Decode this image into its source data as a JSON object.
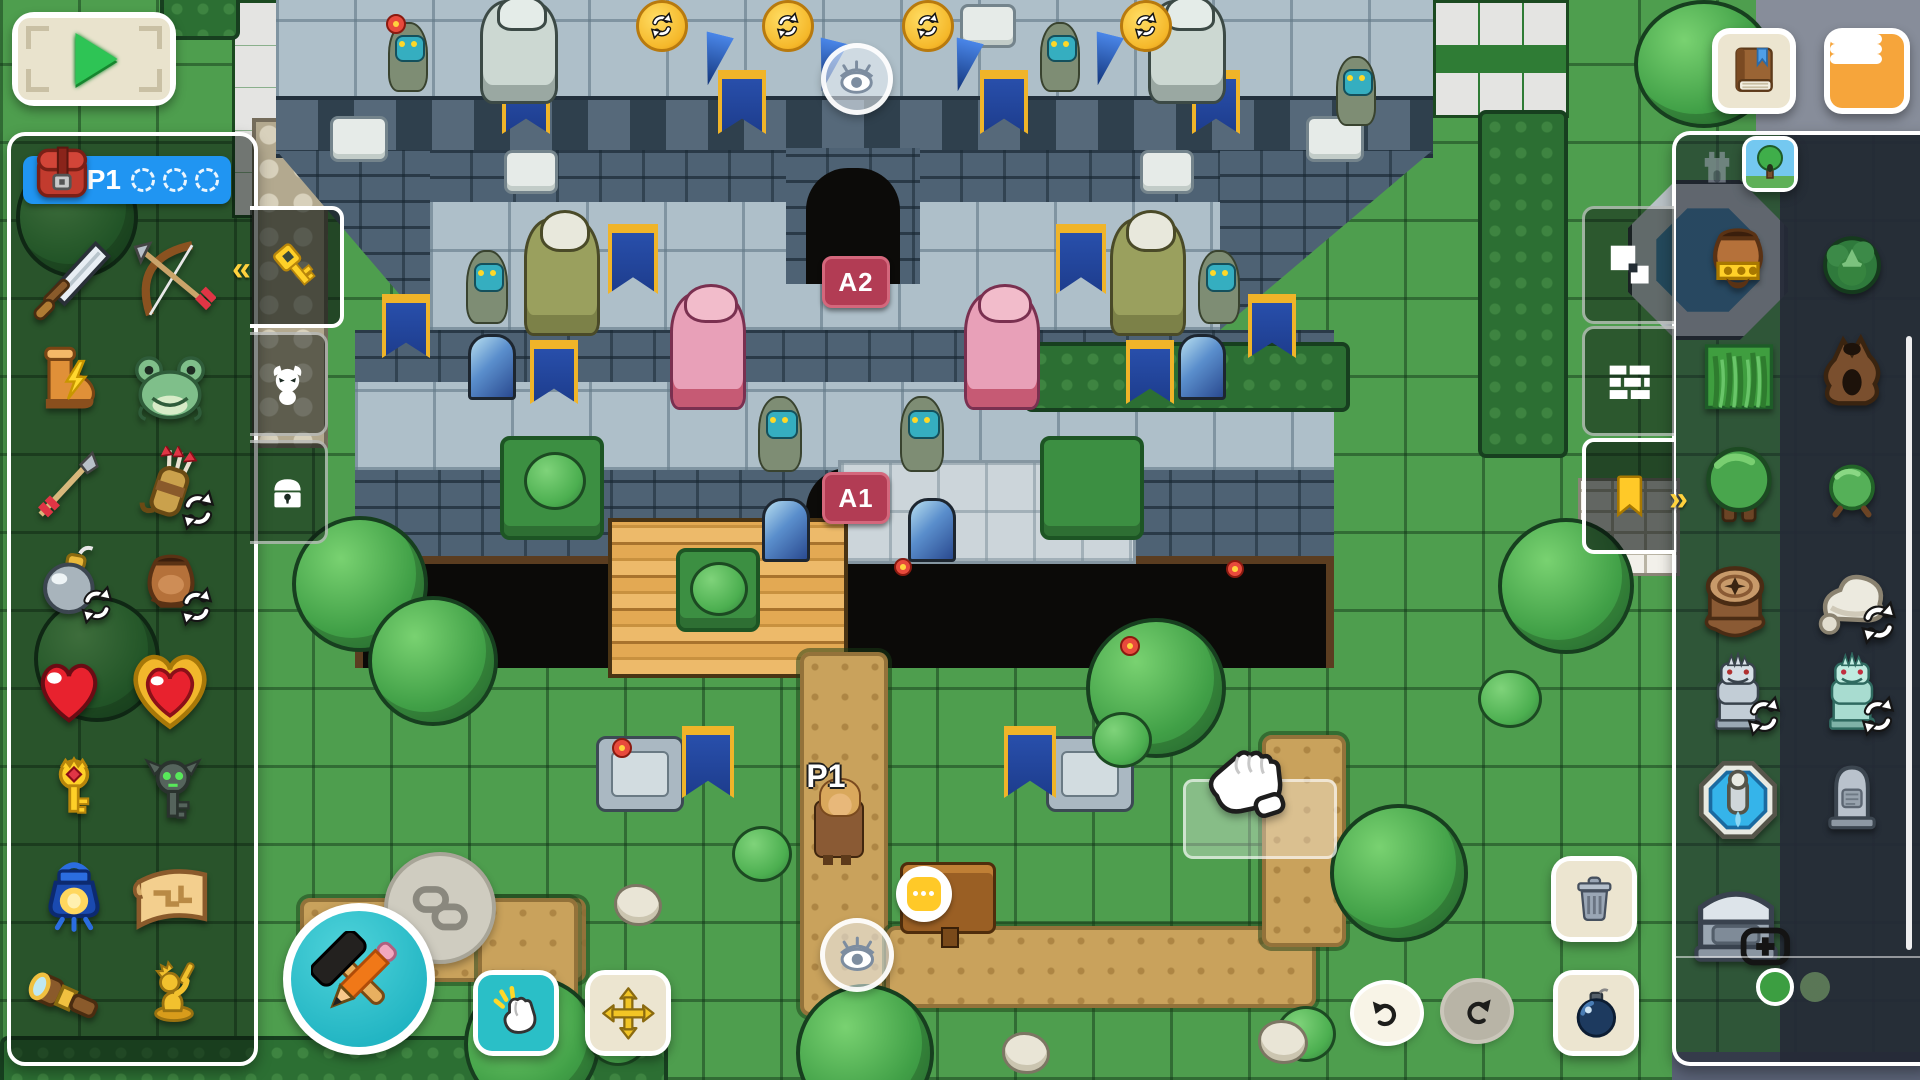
{
  "hud": {
    "play_button": {
      "icon": "play-icon"
    },
    "book_button": {
      "icon": "book-icon"
    },
    "menu_button": {
      "icon": "hamburger-icon"
    },
    "player_bar": {
      "label": "P1",
      "empty_slots": 3
    }
  },
  "left_panel": {
    "tabs": [
      {
        "id": "items",
        "icon": "key-icon",
        "active": true,
        "chevron": "«"
      },
      {
        "id": "enemies",
        "icon": "imp-icon",
        "active": false
      },
      {
        "id": "treasure",
        "icon": "chest-icon",
        "active": false
      }
    ],
    "items": [
      {
        "id": "sword",
        "x": 26,
        "y": 238,
        "s": 88
      },
      {
        "id": "bow",
        "x": 128,
        "y": 236,
        "s": 88
      },
      {
        "id": "boots",
        "x": 30,
        "y": 342,
        "s": 76
      },
      {
        "id": "frog",
        "x": 128,
        "y": 344,
        "s": 84
      },
      {
        "id": "arrow",
        "x": 24,
        "y": 448,
        "s": 80
      },
      {
        "id": "quiver",
        "x": 132,
        "y": 446,
        "s": 80,
        "cycle": true
      },
      {
        "id": "bomb",
        "x": 34,
        "y": 544,
        "s": 76,
        "cycle": true
      },
      {
        "id": "pot",
        "x": 132,
        "y": 544,
        "s": 78,
        "cycle": true
      },
      {
        "id": "heart",
        "x": 30,
        "y": 652,
        "s": 78
      },
      {
        "id": "heart-container",
        "x": 126,
        "y": 646,
        "s": 88
      },
      {
        "id": "boss-key",
        "x": 40,
        "y": 756,
        "s": 68
      },
      {
        "id": "demon-key",
        "x": 136,
        "y": 756,
        "s": 74
      },
      {
        "id": "lantern",
        "x": 34,
        "y": 856,
        "s": 80
      },
      {
        "id": "map-scroll",
        "x": 126,
        "y": 860,
        "s": 88
      },
      {
        "id": "telescope",
        "x": 26,
        "y": 956,
        "s": 84
      },
      {
        "id": "hero-statue",
        "x": 140,
        "y": 954,
        "s": 68
      }
    ]
  },
  "right_panel": {
    "category_tabs": [
      {
        "id": "dungeon",
        "icon": "tower-icon",
        "active": false
      },
      {
        "id": "overworld",
        "icon": "tree-thumbnail-icon",
        "active": true
      }
    ],
    "side_tabs": [
      {
        "id": "ground",
        "icon": "squares-icon",
        "active": false
      },
      {
        "id": "walls",
        "icon": "bricks-icon",
        "active": false
      },
      {
        "id": "decor",
        "icon": "bookmark-icon",
        "active": true,
        "chevron": "»"
      }
    ],
    "tiles": [
      {
        "id": "money-pot",
        "x": 1698,
        "y": 220,
        "s": 80
      },
      {
        "id": "dark-bush",
        "x": 1814,
        "y": 224,
        "s": 76
      },
      {
        "id": "grass-tile",
        "x": 1698,
        "y": 334,
        "s": 82
      },
      {
        "id": "dead-tree",
        "x": 1810,
        "y": 328,
        "s": 84
      },
      {
        "id": "tree",
        "x": 1696,
        "y": 442,
        "s": 86
      },
      {
        "id": "bush",
        "x": 1816,
        "y": 450,
        "s": 72
      },
      {
        "id": "stump",
        "x": 1692,
        "y": 554,
        "s": 86
      },
      {
        "id": "rock",
        "x": 1808,
        "y": 554,
        "s": 86,
        "cycle": true
      },
      {
        "id": "gargoyle-gray",
        "x": 1698,
        "y": 652,
        "s": 80,
        "cycle": true
      },
      {
        "id": "gargoyle-teal",
        "x": 1812,
        "y": 652,
        "s": 80,
        "cycle": true
      },
      {
        "id": "fountain",
        "x": 1694,
        "y": 756,
        "s": 88
      },
      {
        "id": "gravestone",
        "x": 1814,
        "y": 758,
        "s": 76
      },
      {
        "id": "sarcophagus",
        "x": 1686,
        "y": 868,
        "s": 100,
        "plus": true
      }
    ],
    "pagination": {
      "pages": 2,
      "active_page": 1
    }
  },
  "toolbar_bottom": {
    "edit_button": {
      "icon": "hammer-pencil-icon"
    },
    "link_button": {
      "icon": "chain-icon"
    },
    "tap_button": {
      "icon": "tap-hand-icon"
    },
    "move_button": {
      "icon": "move-arrows-icon"
    },
    "undo_button": {
      "icon": "undo-icon",
      "enabled": true
    },
    "redo_button": {
      "icon": "redo-icon",
      "enabled": false
    },
    "trash_button": {
      "icon": "trash-icon"
    },
    "bomb_button": {
      "icon": "bomb-icon"
    }
  },
  "map": {
    "markers": {
      "door_upper": "A2",
      "door_lower": "A1",
      "player_spawn": "P1"
    },
    "objects": [
      {
        "t": "platform",
        "x": 500,
        "y": 436,
        "w": 96,
        "h": 96
      },
      {
        "t": "platform",
        "x": 676,
        "y": 548,
        "w": 76,
        "h": 76
      },
      {
        "t": "platform",
        "x": 1040,
        "y": 436,
        "w": 96,
        "h": 96
      },
      {
        "t": "pedestal",
        "x": 596,
        "y": 736,
        "w": 82,
        "h": 70
      },
      {
        "t": "pedestal",
        "x": 1046,
        "y": 736,
        "w": 82,
        "h": 70
      },
      {
        "t": "plaque",
        "x": 330,
        "y": 116,
        "w": 52,
        "h": 40
      },
      {
        "t": "plaque",
        "x": 1306,
        "y": 116,
        "w": 52,
        "h": 40
      },
      {
        "t": "plaque",
        "x": 504,
        "y": 150,
        "w": 48,
        "h": 38
      },
      {
        "t": "plaque",
        "x": 1140,
        "y": 150,
        "w": 48,
        "h": 38
      },
      {
        "t": "plaque",
        "x": 960,
        "y": 4,
        "w": 50,
        "h": 38
      },
      {
        "t": "window",
        "x": 468,
        "y": 334,
        "w": 42,
        "h": 60
      },
      {
        "t": "window",
        "x": 1178,
        "y": 334,
        "w": 42,
        "h": 60
      },
      {
        "t": "window",
        "x": 762,
        "y": 498,
        "w": 42,
        "h": 58
      },
      {
        "t": "window",
        "x": 908,
        "y": 498,
        "w": 42,
        "h": 58
      },
      {
        "t": "banner",
        "x": 502,
        "y": 70,
        "w": 40,
        "h": 64
      },
      {
        "t": "banner",
        "x": 718,
        "y": 70,
        "w": 40,
        "h": 64
      },
      {
        "t": "banner",
        "x": 980,
        "y": 70,
        "w": 40,
        "h": 64
      },
      {
        "t": "banner",
        "x": 1192,
        "y": 70,
        "w": 40,
        "h": 64
      },
      {
        "t": "banner",
        "x": 608,
        "y": 224,
        "w": 42,
        "h": 70
      },
      {
        "t": "banner",
        "x": 1056,
        "y": 224,
        "w": 42,
        "h": 70
      },
      {
        "t": "banner",
        "x": 382,
        "y": 294,
        "w": 40,
        "h": 64
      },
      {
        "t": "banner",
        "x": 1248,
        "y": 294,
        "w": 40,
        "h": 64
      },
      {
        "t": "banner",
        "x": 530,
        "y": 340,
        "w": 40,
        "h": 64
      },
      {
        "t": "banner",
        "x": 1126,
        "y": 340,
        "w": 40,
        "h": 64
      },
      {
        "t": "banner",
        "x": 682,
        "y": 726,
        "w": 44,
        "h": 72
      },
      {
        "t": "banner",
        "x": 1004,
        "y": 726,
        "w": 44,
        "h": 72
      },
      {
        "t": "white-gargoyle",
        "x": 480,
        "y": 0,
        "w": 72,
        "h": 98
      },
      {
        "t": "white-gargoyle",
        "x": 1148,
        "y": 0,
        "w": 72,
        "h": 98
      },
      {
        "t": "green-griffin",
        "x": 524,
        "y": 218,
        "w": 70,
        "h": 112
      },
      {
        "t": "green-griffin",
        "x": 1110,
        "y": 218,
        "w": 70,
        "h": 112
      },
      {
        "t": "pink-dragon",
        "x": 670,
        "y": 292,
        "w": 70,
        "h": 112
      },
      {
        "t": "pink-dragon",
        "x": 964,
        "y": 292,
        "w": 70,
        "h": 112
      },
      {
        "t": "lizard",
        "x": 466,
        "y": 250,
        "w": 38,
        "h": 70
      },
      {
        "t": "lizard",
        "x": 1198,
        "y": 250,
        "w": 38,
        "h": 70
      },
      {
        "t": "lizard",
        "x": 758,
        "y": 396,
        "w": 40,
        "h": 72
      },
      {
        "t": "lizard",
        "x": 900,
        "y": 396,
        "w": 40,
        "h": 72
      },
      {
        "t": "lizard",
        "x": 388,
        "y": 22,
        "w": 36,
        "h": 66
      },
      {
        "t": "lizard",
        "x": 1040,
        "y": 22,
        "w": 36,
        "h": 66
      },
      {
        "t": "lizard",
        "x": 1336,
        "y": 56,
        "w": 36,
        "h": 66
      },
      {
        "t": "coin",
        "x": 636,
        "y": 0,
        "w": 46,
        "h": 46
      },
      {
        "t": "coin",
        "x": 762,
        "y": 0,
        "w": 46,
        "h": 46
      },
      {
        "t": "coin",
        "x": 902,
        "y": 0,
        "w": 46,
        "h": 46
      },
      {
        "t": "coin",
        "x": 1120,
        "y": 0,
        "w": 46,
        "h": 46
      },
      {
        "t": "spike",
        "x": 700,
        "y": 34,
        "w": 28,
        "h": 52
      },
      {
        "t": "spike",
        "x": 814,
        "y": 40,
        "w": 28,
        "h": 52
      },
      {
        "t": "spike",
        "x": 950,
        "y": 40,
        "w": 28,
        "h": 52
      },
      {
        "t": "spike",
        "x": 1090,
        "y": 34,
        "w": 28,
        "h": 52
      },
      {
        "t": "map-fountain",
        "x": 1628,
        "y": 180,
        "w": 152,
        "h": 152
      },
      {
        "t": "white-bricks",
        "x": 1578,
        "y": 478,
        "w": 96,
        "h": 92
      },
      {
        "t": "tree",
        "x": 292,
        "y": 516,
        "w": 128,
        "h": 128
      },
      {
        "t": "tree",
        "x": 368,
        "y": 596,
        "w": 122,
        "h": 122
      },
      {
        "t": "tree",
        "x": 464,
        "y": 976,
        "w": 128,
        "h": 128
      },
      {
        "t": "tree",
        "x": 1086,
        "y": 618,
        "w": 132,
        "h": 132
      },
      {
        "t": "tree",
        "x": 1330,
        "y": 804,
        "w": 130,
        "h": 130
      },
      {
        "t": "tree",
        "x": 1498,
        "y": 518,
        "w": 128,
        "h": 128
      },
      {
        "t": "tree",
        "x": 796,
        "y": 984,
        "w": 130,
        "h": 130
      },
      {
        "t": "tree",
        "x": 16,
        "y": 156,
        "w": 114,
        "h": 114
      },
      {
        "t": "tree",
        "x": 34,
        "y": 596,
        "w": 118,
        "h": 118
      },
      {
        "t": "tree",
        "x": 1634,
        "y": 0,
        "w": 132,
        "h": 120
      },
      {
        "t": "bush",
        "x": 732,
        "y": 826,
        "w": 54,
        "h": 50
      },
      {
        "t": "bush",
        "x": 1092,
        "y": 712,
        "w": 54,
        "h": 50
      },
      {
        "t": "bush",
        "x": 1478,
        "y": 670,
        "w": 58,
        "h": 52
      },
      {
        "t": "bush",
        "x": 588,
        "y": 1010,
        "w": 54,
        "h": 50
      },
      {
        "t": "bush",
        "x": 1276,
        "y": 1006,
        "w": 54,
        "h": 50
      },
      {
        "t": "bush",
        "x": 524,
        "y": 452,
        "w": 56,
        "h": 52
      },
      {
        "t": "bush",
        "x": 690,
        "y": 562,
        "w": 52,
        "h": 48
      },
      {
        "t": "rock-s",
        "x": 614,
        "y": 884,
        "w": 42,
        "h": 36
      },
      {
        "t": "rock-s",
        "x": 1258,
        "y": 1020,
        "w": 44,
        "h": 38
      },
      {
        "t": "rock-s",
        "x": 1002,
        "y": 1032,
        "w": 42,
        "h": 36
      },
      {
        "t": "flower",
        "x": 386,
        "y": 14,
        "w": 16,
        "h": 16
      },
      {
        "t": "flower",
        "x": 612,
        "y": 738,
        "w": 16,
        "h": 16
      },
      {
        "t": "flower",
        "x": 1120,
        "y": 636,
        "w": 16,
        "h": 16
      },
      {
        "t": "flower",
        "x": 894,
        "y": 558,
        "w": 14,
        "h": 14
      },
      {
        "t": "flower",
        "x": 1226,
        "y": 560,
        "w": 14,
        "h": 14
      },
      {
        "t": "flower",
        "x": 466,
        "y": 902,
        "w": 16,
        "h": 16
      },
      {
        "t": "sign",
        "x": 900,
        "y": 862,
        "w": 90,
        "h": 66
      },
      {
        "t": "sign-bubble",
        "x": 896,
        "y": 866,
        "w": 56,
        "h": 56
      },
      {
        "t": "player",
        "x": 814,
        "y": 800,
        "w": 46,
        "h": 54
      },
      {
        "t": "spawn-label",
        "label": "P1",
        "x": 794,
        "y": 758,
        "w": 64,
        "h": 36
      },
      {
        "t": "eye",
        "x": 821,
        "y": 43,
        "w": 62,
        "h": 62
      },
      {
        "t": "eye",
        "x": 820,
        "y": 918,
        "w": 64,
        "h": 64
      },
      {
        "t": "door-badge",
        "label": "A2",
        "x": 822,
        "y": 256,
        "w": 62,
        "h": 46
      },
      {
        "t": "door-badge",
        "label": "A1",
        "x": 822,
        "y": 472,
        "w": 62,
        "h": 46
      }
    ]
  },
  "colors": {
    "accent_teal": "#2abfc7",
    "accent_orange": "#f6a53b",
    "accent_blue": "#2095f2",
    "badge_red": "#b23c54",
    "highlight_yellow": "#ffd23e",
    "panel_dark": "#272c39",
    "grass_green": "#4e9e4e"
  }
}
